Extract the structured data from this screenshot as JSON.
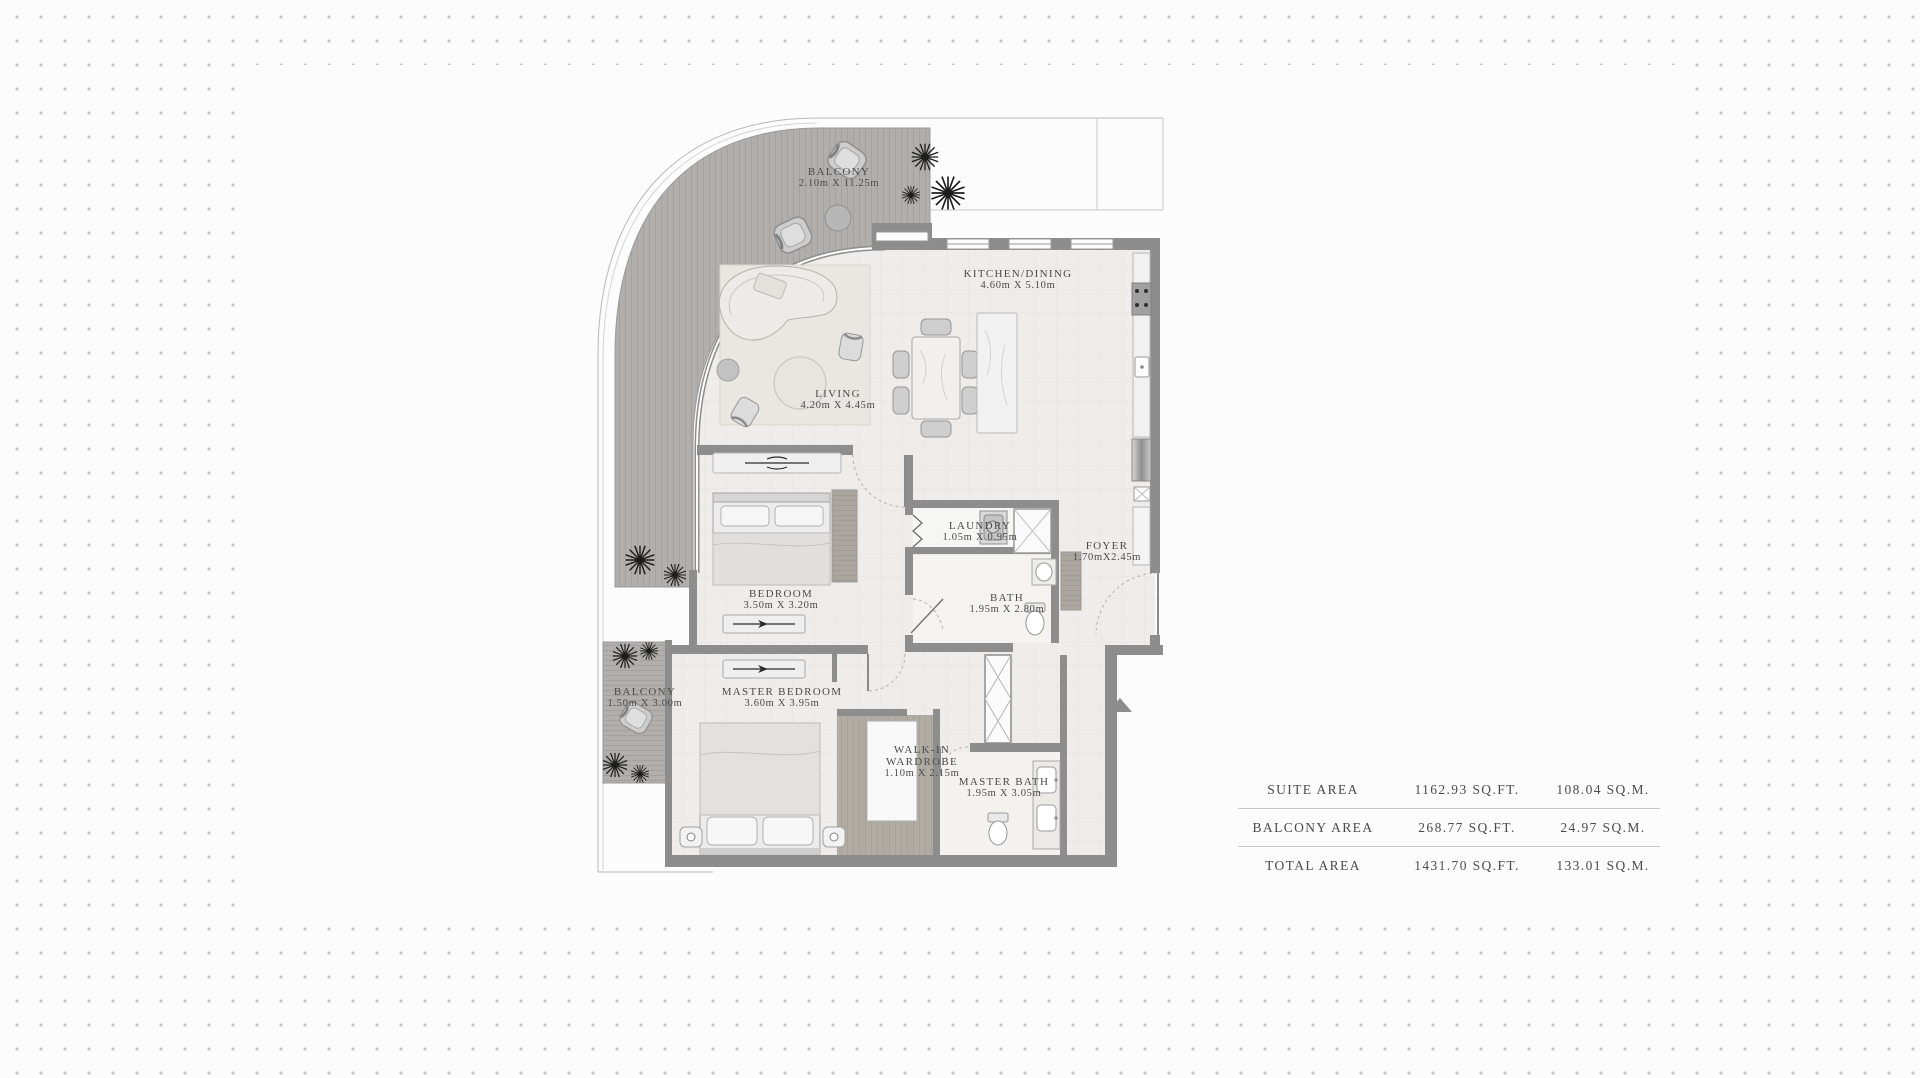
{
  "plan": {
    "rooms": [
      {
        "id": "balcony-top",
        "name": "BALCONY",
        "dims": "2.10m X 11.25m"
      },
      {
        "id": "kitchen-dining",
        "name": "KITCHEN/DINING",
        "dims": "4.60m X 5.10m"
      },
      {
        "id": "living",
        "name": "LIVING",
        "dims": "4.20m X 4.45m"
      },
      {
        "id": "bedroom",
        "name": "BEDROOM",
        "dims": "3.50m X 3.20m"
      },
      {
        "id": "laundry",
        "name": "LAUNDRY",
        "dims": "1.05m X 0.95m"
      },
      {
        "id": "foyer",
        "name": "FOYER",
        "dims": "1.70mX2.45m"
      },
      {
        "id": "bath",
        "name": "BATH",
        "dims": "1.95m X 2.80m"
      },
      {
        "id": "balcony-left",
        "name": "BALCONY",
        "dims": "1.50m X 3.00m"
      },
      {
        "id": "master-bedroom",
        "name": "MASTER BEDROOM",
        "dims": "3.60m X 3.95m"
      },
      {
        "id": "walk-in-wardrobe",
        "name": "WALK-IN",
        "name2": "WARDROBE",
        "dims": "1.10m X 2.15m"
      },
      {
        "id": "master-bath",
        "name": "MASTER BATH",
        "dims": "1.95m X 3.05m"
      }
    ],
    "icons": {
      "entry_arrow": "entry-direction-arrow",
      "plants": "plant-icon",
      "shower": "shower-icon",
      "washer": "washing-machine-icon"
    }
  },
  "area_table": {
    "rows": [
      {
        "label": "SUITE AREA",
        "sqft": "1162.93 SQ.FT.",
        "sqm": "108.04 SQ.M."
      },
      {
        "label": "BALCONY AREA",
        "sqft": "268.77 SQ.FT.",
        "sqm": "24.97 SQ.M."
      },
      {
        "label": "TOTAL AREA",
        "sqft": "1431.70 SQ.FT.",
        "sqm": "133.01 SQ.M."
      }
    ]
  },
  "colors": {
    "wall": "#8d8d8d",
    "deck": "#b0afad",
    "floor": "#eeedec",
    "text": "#4b4b4b",
    "divider": "#c9c9c9",
    "dot": "#c4c4c4",
    "accent_dark": "#1c1c1c"
  }
}
